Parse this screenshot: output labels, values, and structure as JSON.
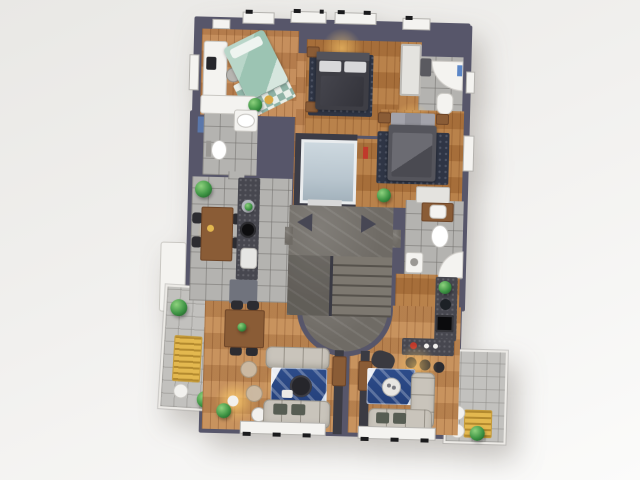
{
  "scene": {
    "type": "3d-architectural-floor-plan",
    "view": "top-down-render",
    "visible_text": [],
    "background": "#f0efed"
  },
  "palette": {
    "bg1": "#e9e8e5",
    "bg2": "#fbfbfa",
    "wall": "#57566a",
    "wallDark": "#3e3e4a",
    "woodA": "#c08653",
    "woodB": "#b1773f",
    "woodC": "#c28a55",
    "tile": "#b4b3b0",
    "tileLight": "#c2c1be",
    "marble": "#6f6b65",
    "stepLight": "#7d7870",
    "stepDark": "#56524c",
    "elevatorCab": "#b9c6cf",
    "elevatorFrame": "#3c3c46",
    "white": "#f4f3f0",
    "softWhite": "#e4e3df",
    "furnWood": "#8a5c36",
    "furnWoodDark": "#6e4527",
    "bedDark": "#3e3e45",
    "bedGray": "#55555c",
    "pillow": "#d8d8da",
    "tealBed": "#9cc4b3",
    "rugNavy": "#2f3545",
    "rugBlue": "#2d4c8a",
    "sofa": "#c9c4bb",
    "cushion": "#575d53",
    "counter": "#47474f",
    "cabinet": "#70737d",
    "plant": "#3e9444",
    "plantDark": "#1e5c27",
    "accentYellow": "#e3b84f",
    "accentGold": "#d9a843",
    "accentRed": "#c0392b",
    "towelBlue": "#5b86c7",
    "chairDark": "#2c2c31"
  },
  "building": {
    "floors_shown": 1,
    "core": [
      "elevator",
      "dogleg-staircase",
      "curved-marble-landing",
      "two-direction-triangles"
    ],
    "plants_count": 10,
    "windows": {
      "top": 5,
      "left": 3,
      "right": 2,
      "bottom": 2
    },
    "rooms": [
      {
        "name": "childrens-bedroom",
        "floor": "wood",
        "furniture": [
          "desk-with-monitor",
          "desk-chair",
          "teal-single-bed",
          "checkered-rug",
          "white-credenza",
          "plant",
          "gold-mirror"
        ]
      },
      {
        "name": "bedroom-2",
        "floor": "wood",
        "furniture": [
          "dark-double-bed",
          "navy-rug",
          "nightstand",
          "nightstand",
          "wardrobe",
          "pendant-light"
        ]
      },
      {
        "name": "bedroom-3",
        "floor": "wood",
        "furniture": [
          "gray-double-bed",
          "navy-rug",
          "nightstand",
          "nightstand",
          "dresser",
          "plant",
          "red-wall-art"
        ]
      },
      {
        "name": "bathroom-top-right",
        "floor": "tile",
        "furniture": [
          "curved-shower",
          "toilet",
          "washer",
          "blue-towel"
        ]
      },
      {
        "name": "bathroom-left",
        "floor": "tile",
        "furniture": [
          "vanity-sink",
          "toilet",
          "window"
        ]
      },
      {
        "name": "bathroom-right-mid",
        "floor": "tile",
        "furniture": [
          "wood-vanity-sink",
          "toilet",
          "curved-shower",
          "washing-machine"
        ]
      },
      {
        "name": "kitchen-dining-left",
        "floor": "tile",
        "furniture": [
          "galley-counter",
          "cooktop",
          "sink",
          "base-cabinet",
          "dining-table",
          "four-chairs",
          "plants"
        ]
      },
      {
        "name": "living-dining-apartment-a",
        "floor": "wood",
        "furniture": [
          "dining-table",
          "four-chairs",
          "sofa",
          "sofa",
          "blue-rug",
          "round-coffee-table",
          "pouf",
          "pouf",
          "floor-lamp",
          "side-table",
          "tv-unit"
        ]
      },
      {
        "name": "living-kitchen-apartment-b",
        "floor": "wood",
        "furniture": [
          "l-sofa",
          "armchair",
          "blue-rug",
          "tray-table",
          "tv-unit",
          "l-counter",
          "cooktop",
          "sink",
          "bar",
          "three-stools",
          "red-flower"
        ]
      },
      {
        "name": "balcony-a",
        "floor": "tile",
        "furniture": [
          "yellow-slatted-table",
          "chair",
          "chair",
          "chair",
          "bush",
          "bush"
        ]
      },
      {
        "name": "balcony-b",
        "floor": "tile",
        "furniture": [
          "yellow-slatted-table",
          "chair",
          "chair",
          "bush"
        ]
      }
    ]
  }
}
